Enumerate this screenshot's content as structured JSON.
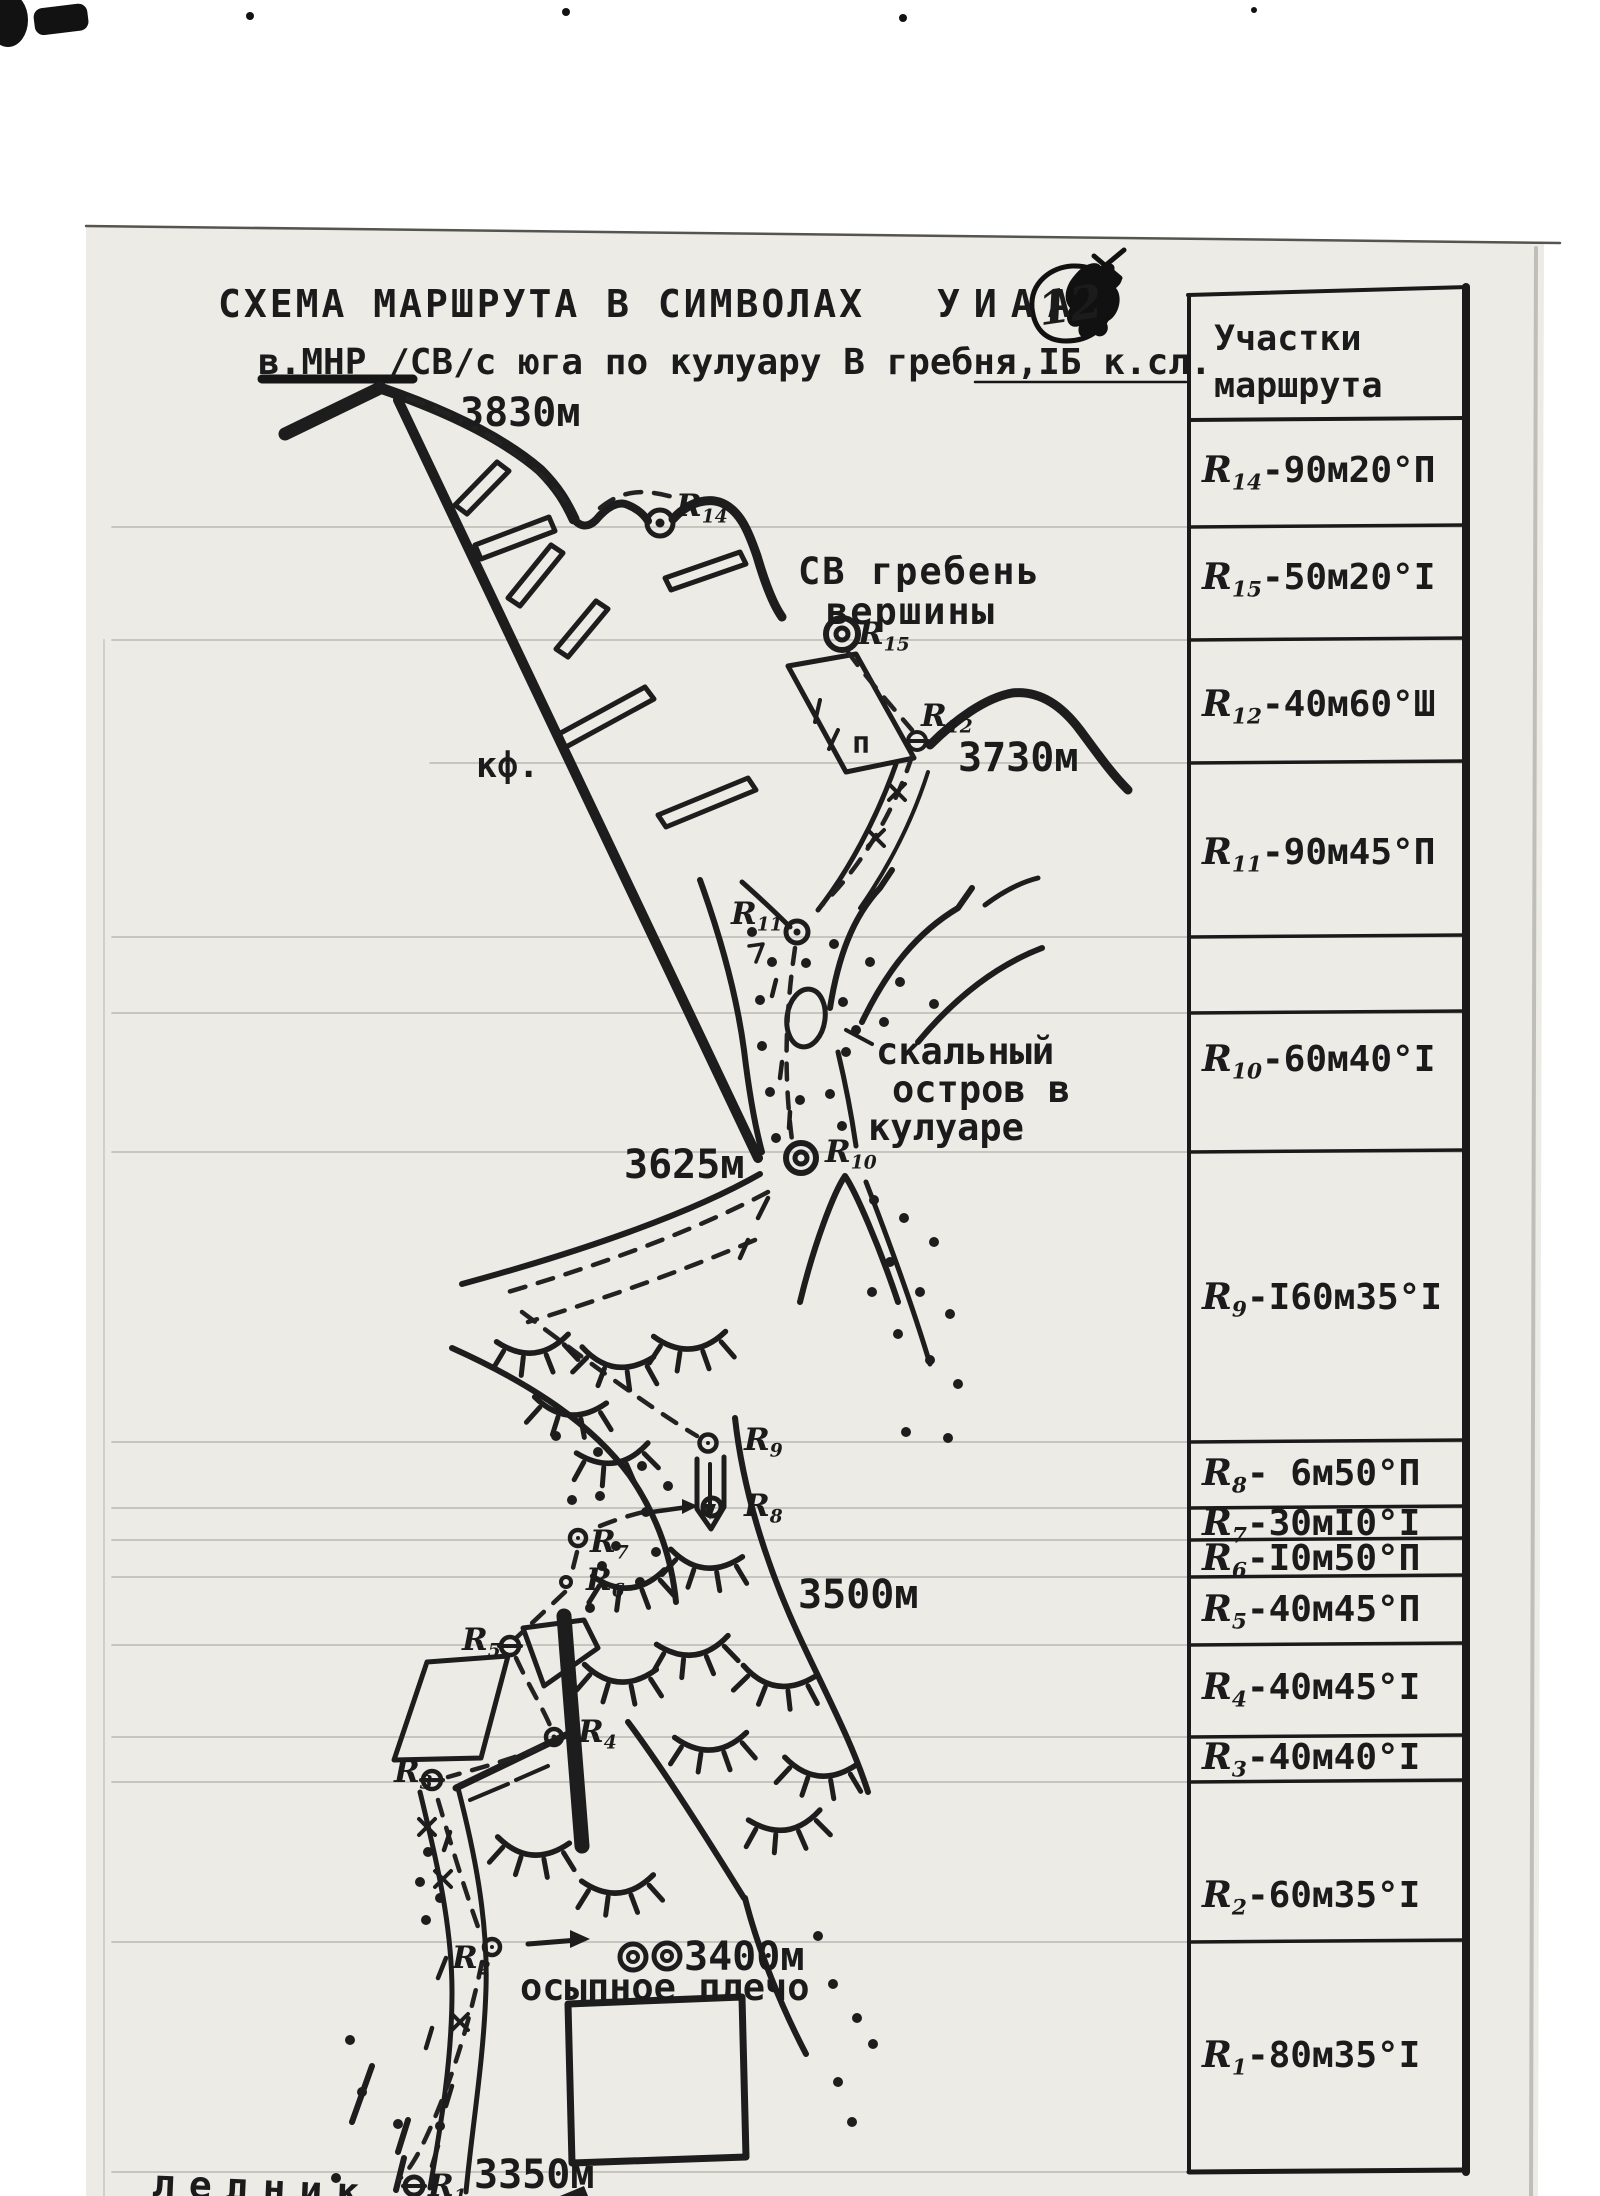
{
  "page": {
    "title_main": "СХЕМА  МАРШРУТА  В  СИМВОЛАХ",
    "title_org": "УИАА",
    "page_number": "12",
    "subtitle": "в.МНР /СВ/с юга по кулуару В гребня,IБ к.сл."
  },
  "colors": {
    "ink": "#1d1d1d",
    "paper": "#ecebe6",
    "ruled_line": "#90908a"
  },
  "table": {
    "header": "Участки маршрута",
    "rows": [
      {
        "point_letter": "R",
        "point_sub": "14",
        "info": "-90м20°П"
      },
      {
        "point_letter": "R",
        "point_sub": "15",
        "info": "-50м20°I"
      },
      {
        "point_letter": "R",
        "point_sub": "12",
        "info": "-40м60°Ш"
      },
      {
        "point_letter": "R",
        "point_sub": "11",
        "info": "-90м45°П"
      },
      {
        "point_letter": "R",
        "point_sub": "10",
        "info": "-60м40°I"
      },
      {
        "point_letter": "R",
        "point_sub": "9",
        "info": "-I60м35°I"
      },
      {
        "point_letter": "R",
        "point_sub": "8",
        "info": "- 6м50°П"
      },
      {
        "point_letter": "R",
        "point_sub": "7",
        "info": "-30мI0°I"
      },
      {
        "point_letter": "R",
        "point_sub": "6",
        "info": "-I0м50°П"
      },
      {
        "point_letter": "R",
        "point_sub": "5",
        "info": "-40м45°П"
      },
      {
        "point_letter": "R",
        "point_sub": "4",
        "info": "-40м45°I"
      },
      {
        "point_letter": "R",
        "point_sub": "3",
        "info": "-40м40°I"
      },
      {
        "point_letter": "R",
        "point_sub": "2",
        "info": "-60м35°I"
      },
      {
        "point_letter": "R",
        "point_sub": "1",
        "info": "-80м35°I"
      }
    ]
  },
  "map": {
    "labels": {
      "summit_alt": "3830м",
      "ridge_line1": "СВ гребень",
      "ridge_line2": "вершины",
      "buttress_mark": "кф.",
      "alt_3730": "3730м",
      "island_line1": "скальный",
      "island_line2": "остров в",
      "island_line3": "кулуаре",
      "alt_3625": "3625м",
      "alt_3500": "3500м",
      "alt_3400": "3400м",
      "scree_shoulder": "осыпное плечо",
      "alt_3350": "3350м",
      "glacier": "ледник",
      "p_mark": "п"
    },
    "points": {
      "r14": {
        "letter": "R",
        "sub": "14"
      },
      "r15": {
        "letter": "R",
        "sub": "15"
      },
      "r12": {
        "letter": "R",
        "sub": "12"
      },
      "r11": {
        "letter": "R",
        "sub": "11"
      },
      "r10": {
        "letter": "R",
        "sub": "10"
      },
      "r9": {
        "letter": "R",
        "sub": "9"
      },
      "r8": {
        "letter": "R",
        "sub": "8"
      },
      "r7": {
        "letter": "R",
        "sub": "7"
      },
      "r6": {
        "letter": "R",
        "sub": "6"
      },
      "r5": {
        "letter": "R",
        "sub": "5"
      },
      "r4": {
        "letter": "R",
        "sub": "4"
      },
      "r3": {
        "letter": "R",
        "sub": "3"
      },
      "r2": {
        "letter": "R",
        "sub": "2"
      },
      "r1": {
        "letter": "R",
        "sub": "1"
      }
    }
  }
}
